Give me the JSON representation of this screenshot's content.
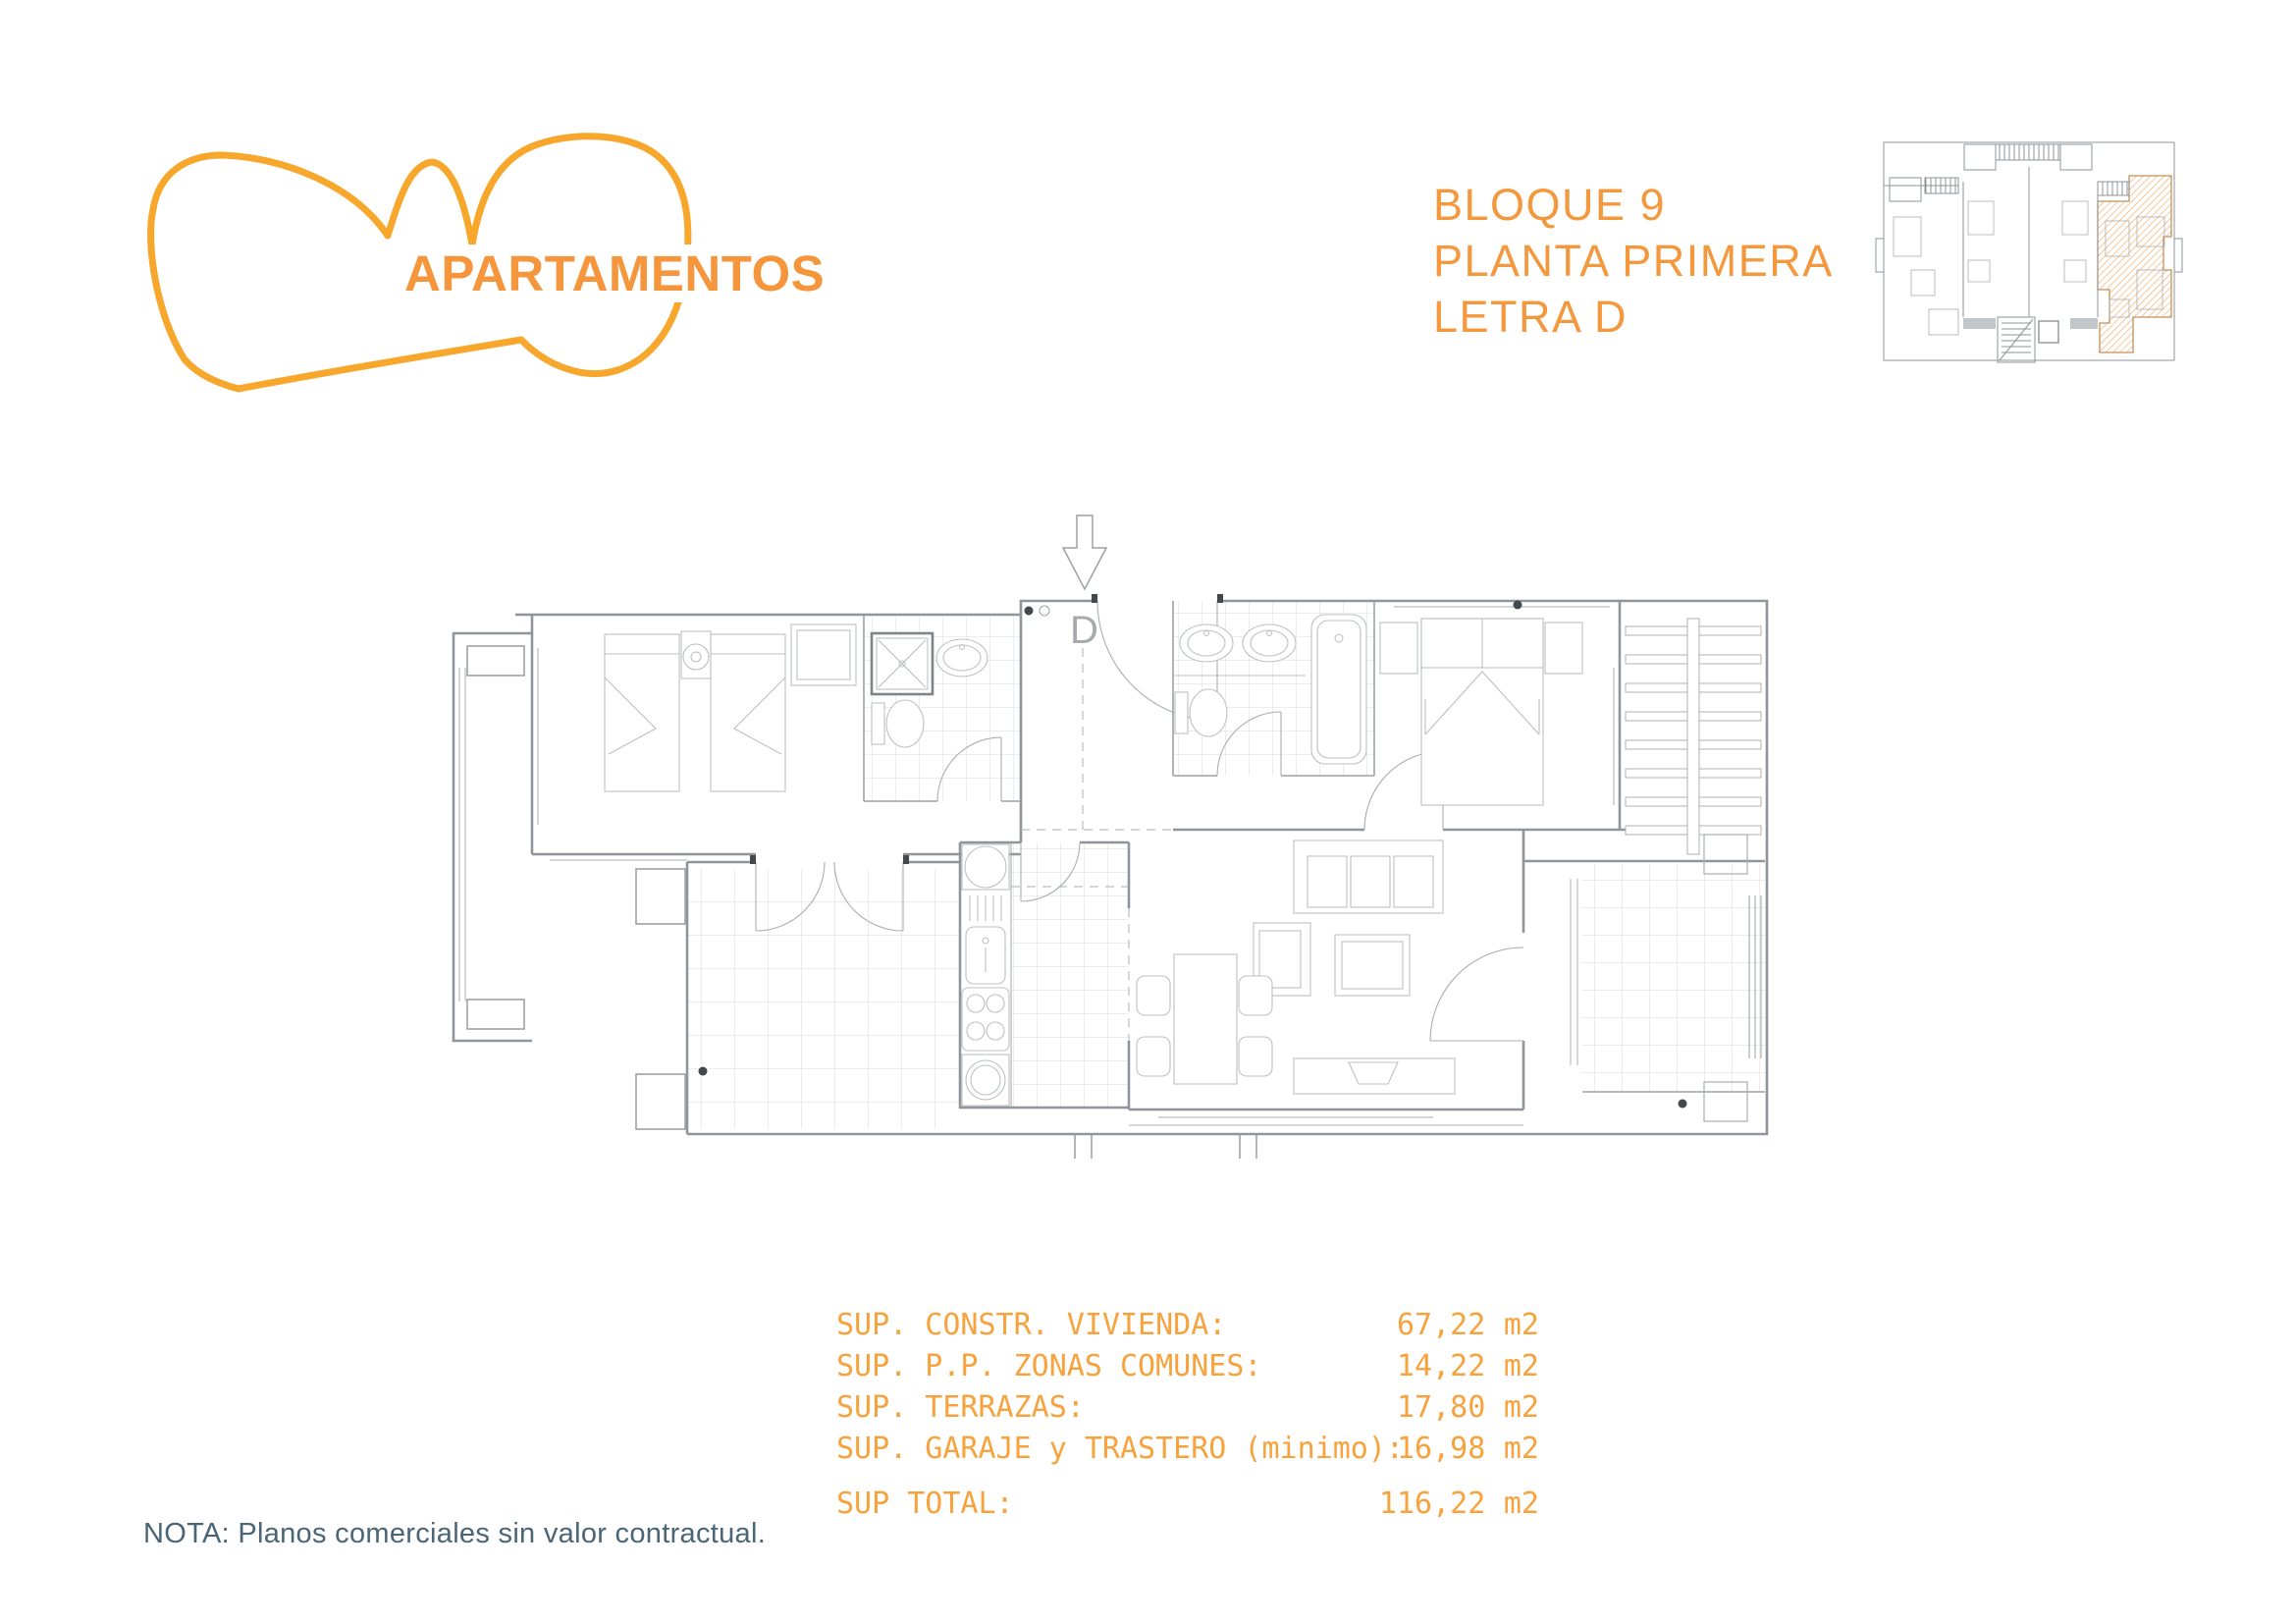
{
  "logo": {
    "brand_text": "APARTAMENTOS",
    "stroke_color": "#F7A72B",
    "text_color": "#F5953C"
  },
  "title": {
    "line1": "BLOQUE 9",
    "line2": "PLANTA PRIMERA",
    "line3": "LETRA D",
    "color": "#F4983E"
  },
  "key_plan": {
    "highlighted_unit": "D",
    "hatch_color": "#EBA45C",
    "outline_color": "#C2915A",
    "line_color": "#8F9498"
  },
  "floor_plan": {
    "entrance_label": "D",
    "line_color": "#9CA1A5"
  },
  "surface_table": {
    "color": "#F7A23C",
    "rows": [
      {
        "label": "SUP. CONSTR. VIVIENDA:",
        "value": "67,22",
        "unit": "m2"
      },
      {
        "label": "SUP. P.P. ZONAS COMUNES:",
        "value": "14,22",
        "unit": "m2"
      },
      {
        "label": "SUP. TERRAZAS:",
        "value": "17,80",
        "unit": "m2"
      },
      {
        "label": "SUP. GARAJE y TRASTERO (minimo):",
        "value": "16,98",
        "unit": "m2"
      }
    ],
    "total": {
      "label": "SUP TOTAL:",
      "value": "116,22",
      "unit": "m2"
    }
  },
  "footnote": {
    "text": "NOTA: Planos comerciales sin valor contractual.",
    "color": "#4A6575"
  }
}
